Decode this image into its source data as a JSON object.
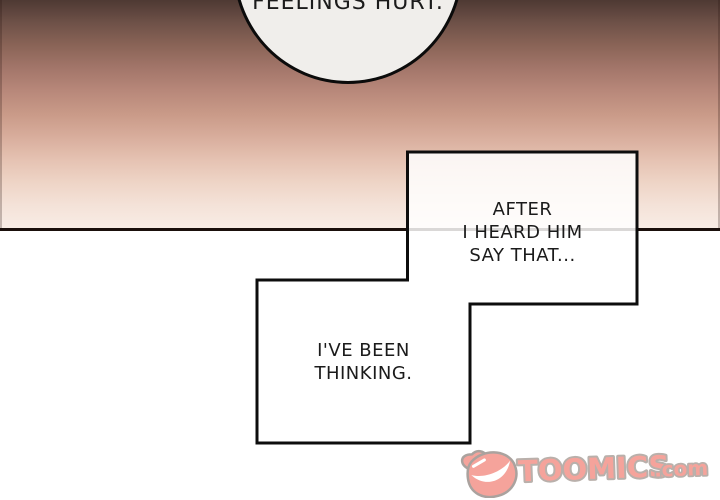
{
  "page": {
    "type": "webtoon-comic-panel",
    "width": 720,
    "height": 500
  },
  "speech": {
    "top_bubble": {
      "text": "FEELINGS HURT."
    },
    "after_box": {
      "lines": [
        "AFTER",
        "I HEARD HIM",
        "SAY THAT..."
      ]
    },
    "thinking_box": {
      "lines": [
        "I'VE BEEN",
        "THINKING."
      ]
    }
  },
  "watermark": {
    "brand": "TOOMICS",
    "tld": ".com",
    "icon": "toomics-grin-face-icon"
  },
  "colors": {
    "gradient_top": "#4e3933",
    "gradient_mid_salmon": "#c99a88",
    "gradient_bottom": "#f8ece5",
    "panel_border": "#1a0f0b",
    "bubble_fill": "#f0eeeb",
    "box_fill": "rgba(255,255,255,0.84)",
    "outline_black": "#0d0d0d",
    "text": "#1b1b1b",
    "logo_pink": "#f5a39b",
    "logo_outline": "#b9b0ab",
    "background": "#ffffff"
  }
}
